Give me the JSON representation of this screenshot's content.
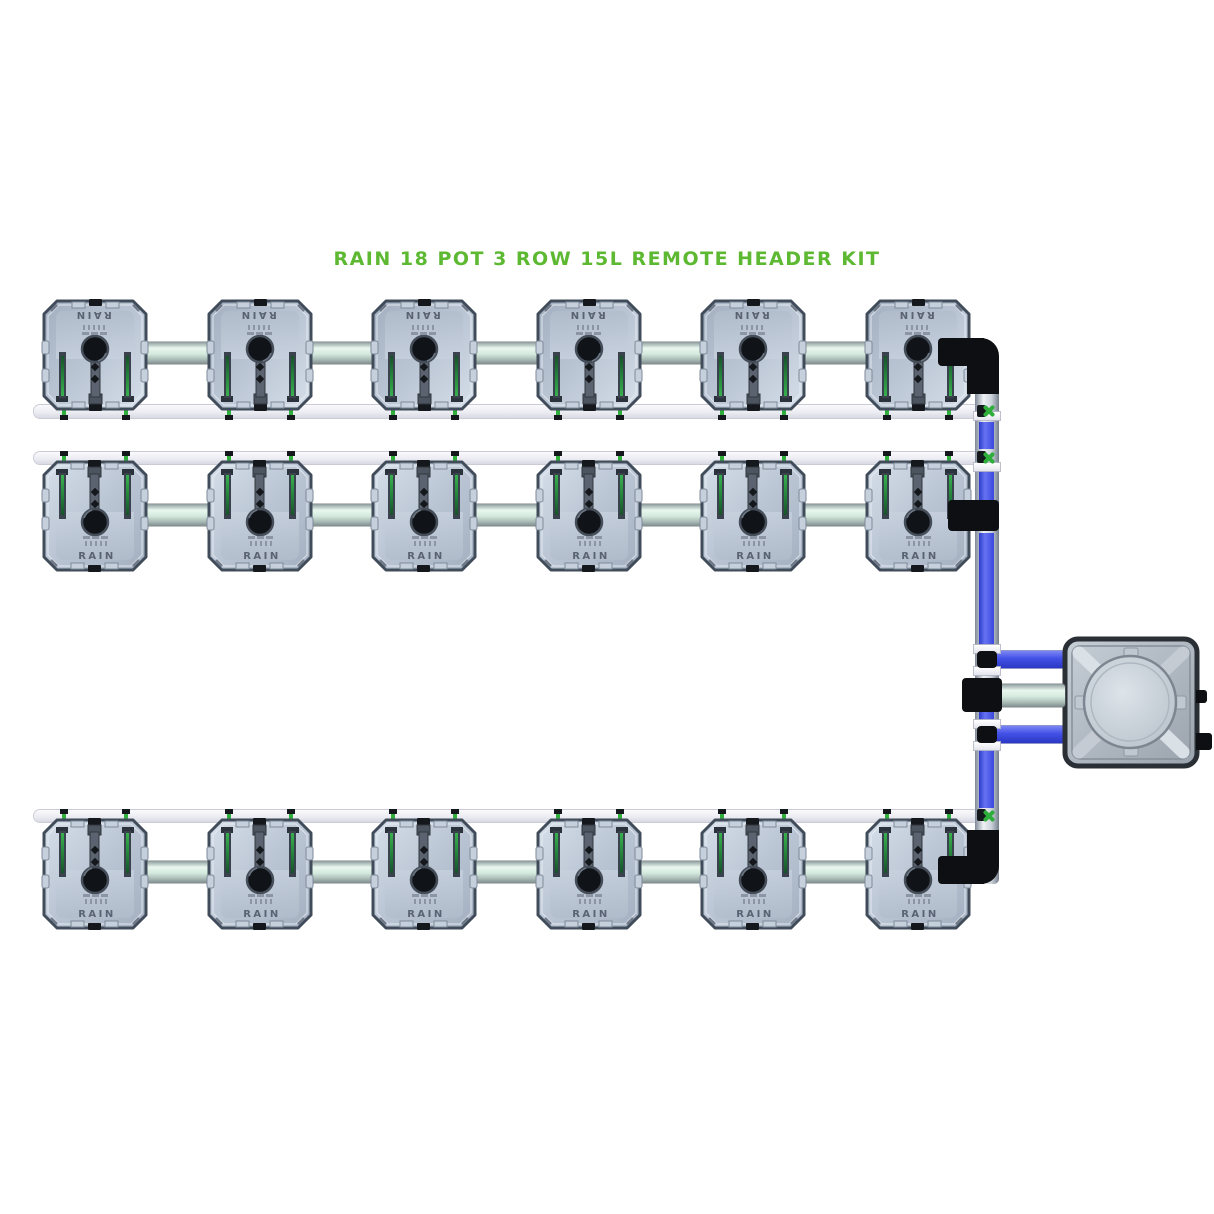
{
  "title": {
    "text": "RAIN 18 POT 3 ROW 15L REMOTE HEADER KIT"
  },
  "kit": {
    "pot_label": "RAIN",
    "pot_count": 18,
    "row_count": 3,
    "pots_per_row": 6,
    "pot_size": "15L",
    "rows": [
      {
        "id": "pot-row-1",
        "orientation": "inverted",
        "pot_count": 6
      },
      {
        "id": "pot-row-2",
        "orientation": "upright",
        "pot_count": 6
      },
      {
        "id": "pot-row-3",
        "orientation": "upright",
        "pot_count": 6
      }
    ],
    "components": {
      "header_tank": "remote-header-tank",
      "feed_pipe": "blue-feed-pipe",
      "manifold_pipe": "silver-manifold-pipe",
      "drip_pipe": "white-drip-pipe"
    }
  },
  "colors": {
    "title_green": "#5db832",
    "pipe_blue": "#4250e6",
    "pipe_white": "#ececf3",
    "pipe_silver": "#d4e9dd",
    "pot_body": "#bac5d4",
    "fitting_black": "#0d0f12",
    "connector_green": "#2fae3c",
    "background": "#ffffff"
  }
}
